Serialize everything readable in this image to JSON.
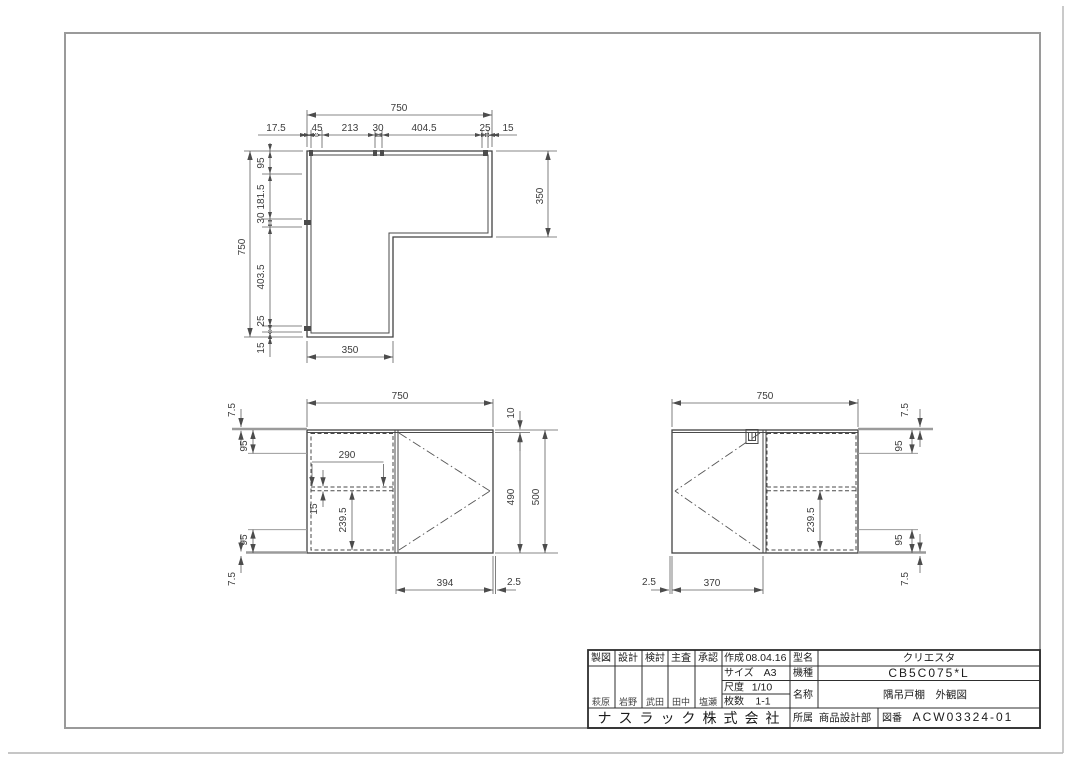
{
  "drawing": {
    "plan": {
      "overall_width": "750",
      "top_chain": [
        "17.5",
        "45",
        "213",
        "30",
        "404.5",
        "25",
        "15"
      ],
      "overall_depth": "750",
      "left_chain": [
        "95",
        "181.5",
        "30",
        "403.5",
        "25",
        "15"
      ],
      "right_depth": "350",
      "bottom_width": "350"
    },
    "front": {
      "width": "750",
      "top_gap": "10",
      "door_height": "490",
      "height": "500",
      "left_top": [
        "7.5",
        "95"
      ],
      "left_bottom": [
        "95",
        "7.5"
      ],
      "shelf_pin_span": "290",
      "shelf_thickness": "15",
      "shelf_height": "239.5",
      "door_width": "394",
      "edge_gap": "2.5"
    },
    "side": {
      "width": "750",
      "right_top": [
        "7.5",
        "95"
      ],
      "right_bottom": [
        "95",
        "7.5"
      ],
      "shelf_height": "239.5",
      "door_width": "370",
      "edge_gap": "2.5"
    }
  },
  "title_block": {
    "roles": [
      {
        "label": "製図",
        "name": "萩原"
      },
      {
        "label": "設計",
        "name": "岩野"
      },
      {
        "label": "検討",
        "name": "武田"
      },
      {
        "label": "主査",
        "name": "田中"
      },
      {
        "label": "承認",
        "name": "塩瀬"
      }
    ],
    "created_label": "作成",
    "created_value": "08.04.16",
    "size_label": "サイズ",
    "size_value": "A3",
    "scale_label": "尺度",
    "scale_value": "1/10",
    "sheets_label": "枚数",
    "sheets_value": "1-1",
    "model_label": "型名",
    "model_value": "クリエスタ",
    "machine_label": "機種",
    "machine_value": "CB5C075*L",
    "item_label": "名称",
    "item_value": "隅吊戸棚　外観図",
    "dept_label": "所属",
    "dept_value": "商品設計部",
    "dwgno_label": "図番",
    "dwgno_value": "ACW03324-01",
    "company": "ナスラック株式会社"
  }
}
